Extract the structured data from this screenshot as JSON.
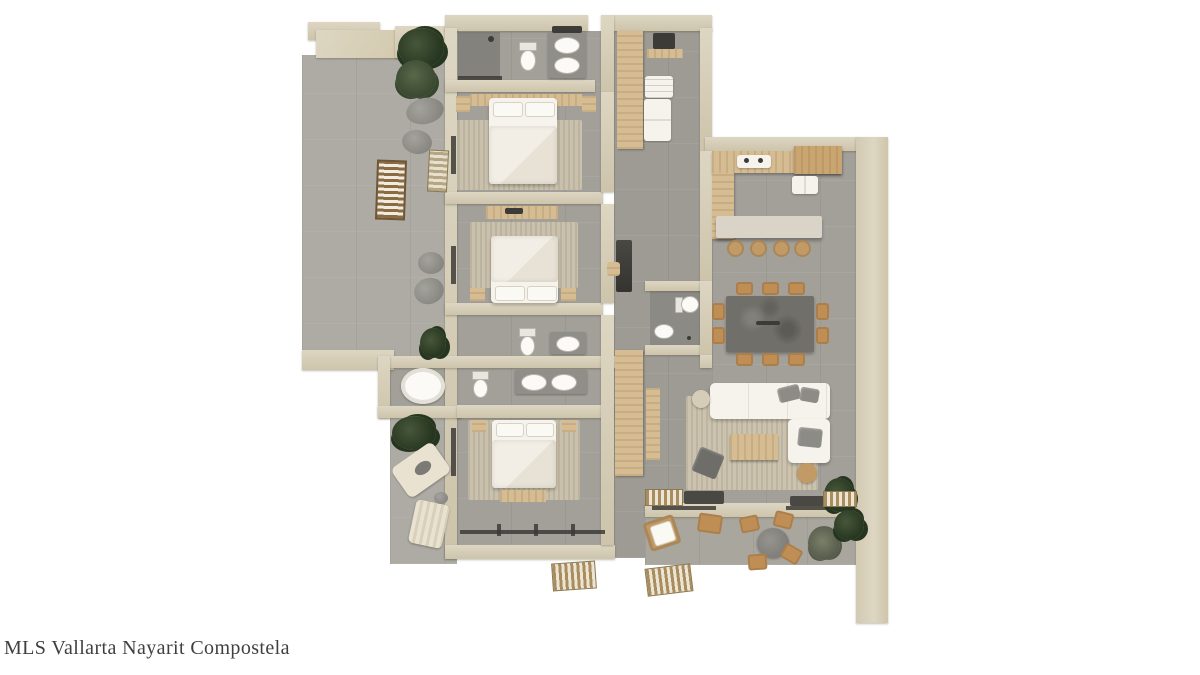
{
  "watermark": {
    "text": "MLS Vallarta Nayarit Compostela"
  },
  "palette": {
    "background": "#ffffff",
    "wall": "#ddd6c2",
    "wallDark": "#cdc4ab",
    "floor": "#a3a09a",
    "floorLight": "#aeaba4",
    "floorDark": "#82807b",
    "wood": "#d6bc92",
    "woodDark": "#c19a66",
    "white": "#f6f3ec",
    "charcoal": "#3d3b37",
    "grayItem": "#8d8b86",
    "plantDark": "#26351f",
    "plantLight": "#47573a",
    "rug": "#c9c1ac",
    "stoneTable": "#716f69",
    "chairWood": "#bf8e55"
  }
}
